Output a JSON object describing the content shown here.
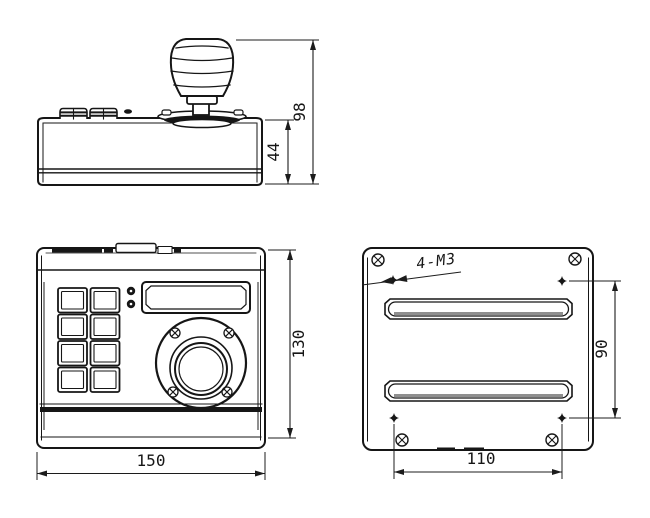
{
  "drawing": {
    "kind": "joystick-keyboard-dimension-drawing",
    "colors": {
      "line": "#161616",
      "background": "#ffffff"
    },
    "views": {
      "side_view": {
        "name": "side elevation",
        "dims": {
          "overall_height": "98",
          "body_height": "44"
        }
      },
      "front_view": {
        "name": "top panel view",
        "dims": {
          "height": "130",
          "width": "150"
        }
      },
      "bottom_view": {
        "name": "bottom mounting plate",
        "annotation": "4-M3",
        "dims": {
          "hole_spacing_vertical": "90",
          "hole_spacing_horizontal": "110"
        }
      }
    }
  }
}
